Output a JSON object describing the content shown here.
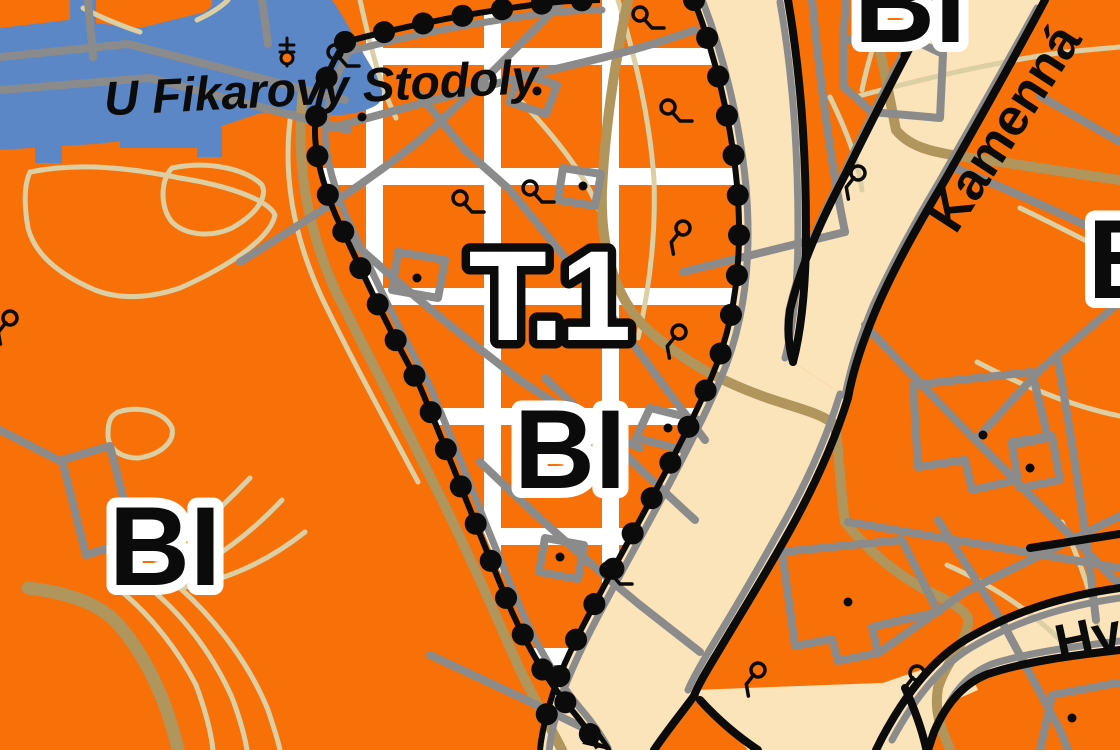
{
  "map": {
    "type": "zoning-plan-map",
    "labels": {
      "region": {
        "text": "T.1"
      },
      "zones": {
        "center": "BI",
        "left": "BI",
        "top_right": "BI",
        "right_partial": "B"
      },
      "streets": {
        "main": "U Fikarovy Stodoly",
        "kamenna": "Kamenná",
        "hv_partial": "Hv",
        "bottom_partial": "ý"
      }
    },
    "colors": {
      "orange": "#f77008",
      "cream": "#fbe3ba",
      "blue": "#5b87c6",
      "gray": "#8b8b8b",
      "ltan": "#ddcfa4",
      "dtan": "#b0955c",
      "black": "#0b0b0b",
      "white": "#ffffff"
    },
    "symbols": {
      "well": {
        "glyph": "circle-with-hook",
        "positions": [
          [
            335,
            52,
            0
          ],
          [
            640,
            14,
            0
          ],
          [
            668,
            107,
            0
          ],
          [
            460,
            198,
            0
          ],
          [
            530,
            188,
            0
          ],
          [
            683,
            228,
            80
          ],
          [
            679,
            332,
            80
          ],
          [
            858,
            173,
            80
          ],
          [
            608,
            570,
            0
          ],
          [
            758,
            670,
            80
          ],
          [
            917,
            673,
            80
          ],
          [
            10,
            318,
            80
          ]
        ]
      },
      "monument": {
        "glyph": "cross-staff",
        "position": [
          287,
          52
        ]
      }
    },
    "building_dots": [
      [
        537,
        91
      ],
      [
        583,
        186
      ],
      [
        417,
        278
      ],
      [
        362,
        117
      ],
      [
        668,
        428
      ],
      [
        560,
        557
      ],
      [
        905,
        55
      ],
      [
        983,
        435
      ],
      [
        1030,
        468
      ],
      [
        848,
        602
      ],
      [
        1072,
        718
      ]
    ]
  }
}
